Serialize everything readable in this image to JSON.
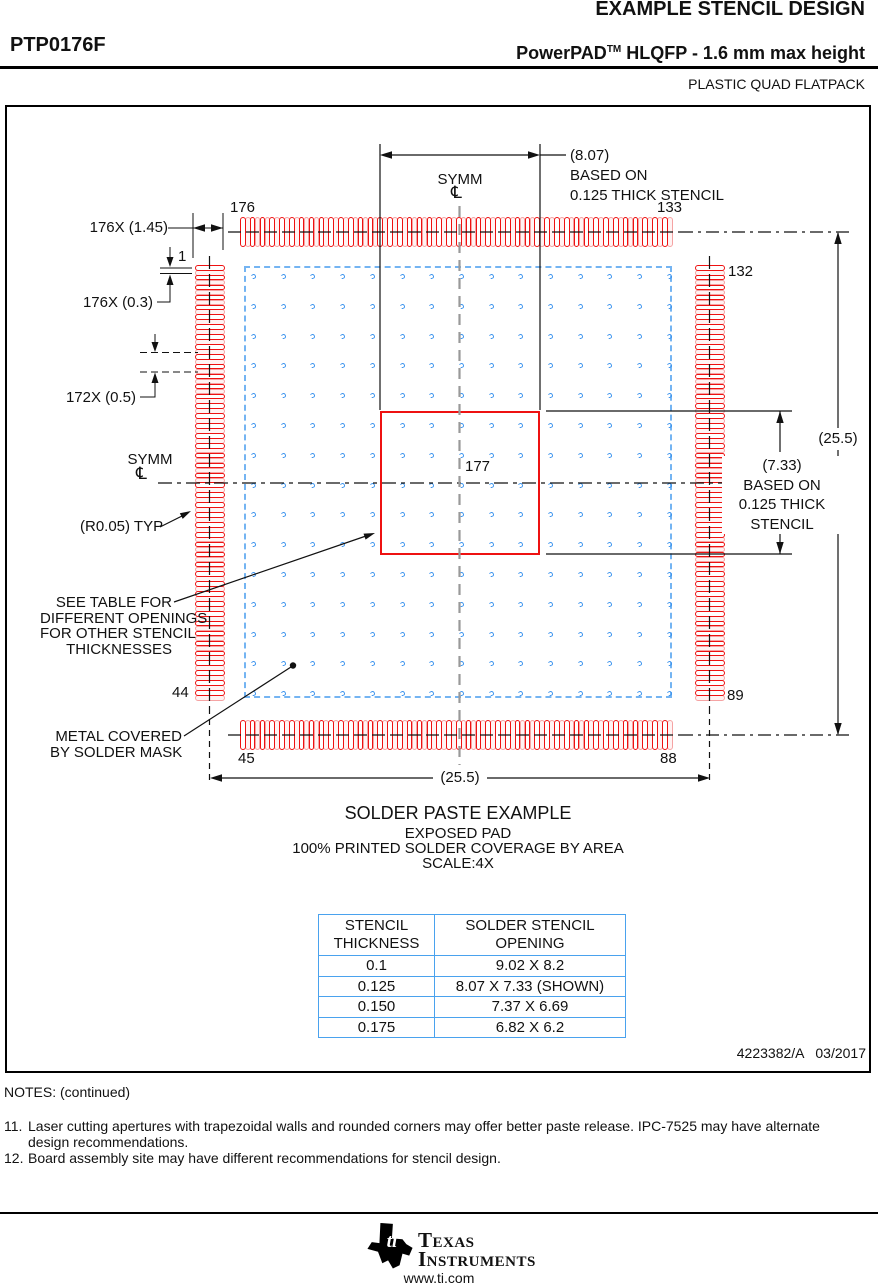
{
  "header": {
    "title": "EXAMPLE STENCIL DESIGN",
    "part_number": "PTP0176F",
    "family": "PowerPAD",
    "trademark": "TM",
    "subtitle_rest": " HLQFP - 1.6 mm max height",
    "package_type": "PLASTIC QUAD FLATPACK"
  },
  "drawing": {
    "dim_pad_length": "176X (1.45)",
    "dim_pad_width": "176X (0.3)",
    "dim_pitch": "172X (0.5)",
    "symm_top": "SYMM",
    "symm_left": "SYMM",
    "centerline_symbol": "℄",
    "radius_typ": "(R0.05) TYP",
    "see_table": [
      "SEE TABLE FOR",
      "DIFFERENT OPENINGS",
      "FOR OTHER STENCIL",
      "THICKNESSES"
    ],
    "metal_covered": [
      "METAL COVERED",
      "BY SOLDER MASK"
    ],
    "pins": {
      "p1": "1",
      "p44": "44",
      "p45": "45",
      "p88": "88",
      "p89": "89",
      "p132": "132",
      "p133": "133",
      "p176": "176",
      "p177": "177"
    },
    "dim_top": [
      "(8.07)",
      "BASED ON",
      "0.125 THICK STENCIL"
    ],
    "dim_right": [
      "(7.33)",
      "BASED ON",
      "0.125 THICK",
      "STENCIL"
    ],
    "dim_25_right": "(25.5)",
    "dim_25_bottom": "(25.5)",
    "caption": [
      "SOLDER PASTE EXAMPLE",
      "EXPOSED PAD",
      "100% PRINTED SOLDER COVERAGE BY AREA",
      "SCALE:4X"
    ],
    "doc_number": "4223382/A   03/2017"
  },
  "table": {
    "headers": [
      [
        "STENCIL",
        "THICKNESS"
      ],
      [
        "SOLDER STENCIL",
        "OPENING"
      ]
    ],
    "rows": [
      [
        "0.1",
        "9.02 X 8.2"
      ],
      [
        "0.125",
        "8.07 X 7.33 (SHOWN)"
      ],
      [
        "0.150",
        "7.37 X 6.69"
      ],
      [
        "0.175",
        "6.82 X 6.2"
      ]
    ]
  },
  "notes": {
    "heading": "NOTES: (continued)",
    "items": [
      {
        "num": "11.",
        "lines": [
          "Laser cutting apertures with trapezoidal walls and rounded corners may offer better paste release. IPC-7525 may have alternate",
          "design recommendations."
        ]
      },
      {
        "num": "12.",
        "lines": [
          "Board assembly site may have different recommendations for stencil design."
        ]
      }
    ]
  },
  "footer": {
    "brand_line1": "Texas",
    "brand_line2": "Instruments",
    "logo_ti": "ti",
    "url": "www.ti.com"
  },
  "colors": {
    "pad_red": "#ee1111",
    "pad_pink": "#f5a3a3",
    "paste_blue": "#3b93ee",
    "outline_blue": "#74b4f2",
    "table_blue": "#4aa2ee",
    "centerline_gray": "#999999"
  }
}
